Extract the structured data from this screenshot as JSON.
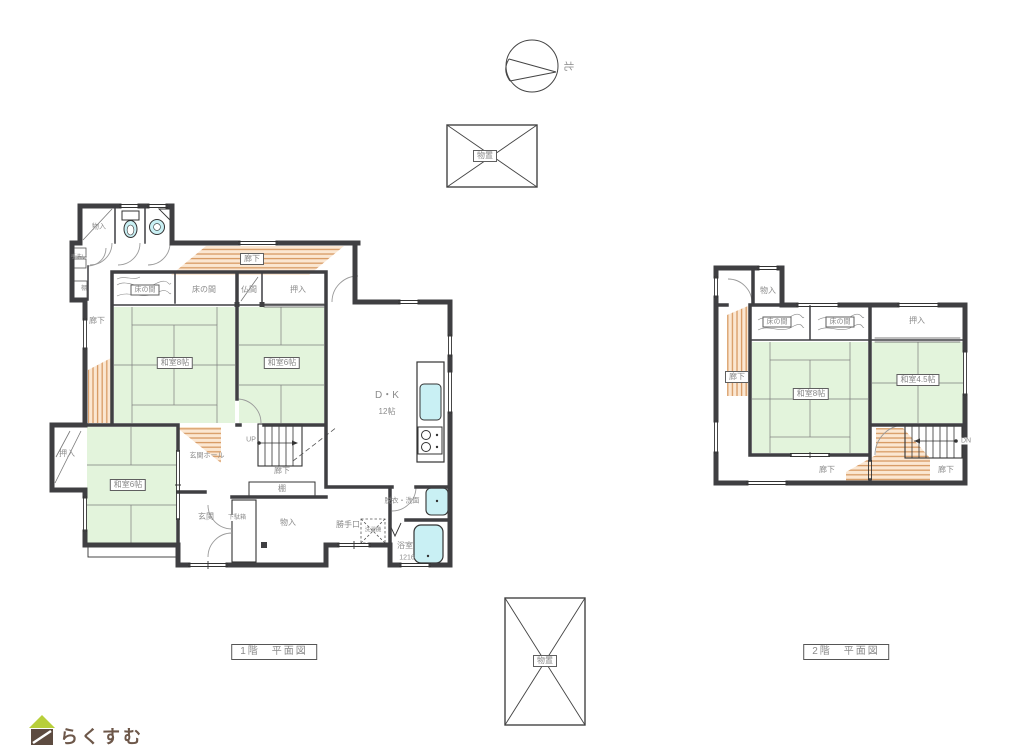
{
  "compass": {
    "north": "北"
  },
  "sheds": {
    "top": "物置",
    "bottom": "物置"
  },
  "floor1": {
    "caption": "1階　平面図",
    "labels": {
      "monoire_top": "物入",
      "tearai": "手洗い",
      "tana_left": "棚",
      "rouka_top": "廊下",
      "tokonoma_a": "床の間",
      "tokonoma_b": "床の間",
      "butsuma": "仏間",
      "oshiire_top": "押入",
      "rouka_left": "廊下",
      "washitsu8": "和室8帖",
      "washitsu6_ne": "和室6帖",
      "dk": "D・K",
      "dk_size": "12帖",
      "oshiire_sw": "押入",
      "washitsu6_sw": "和室6帖",
      "genkan_hall": "玄関ホール",
      "up": "UP",
      "rouka_mid": "廊下",
      "tana_shelf": "棚",
      "genkan": "玄関",
      "getabako": "下駄箱",
      "monoire_low": "物入",
      "katteguchi": "勝手口",
      "sentakuki": "洗濯機",
      "datsui_senmen": "脱衣・洗面",
      "yokushitsu": "浴室",
      "bath_size": "1216"
    }
  },
  "floor2": {
    "caption": "2階　平面図",
    "labels": {
      "monoire": "物入",
      "tokonoma_a": "床の間",
      "tokonoma_b": "床の間",
      "oshiire": "押入",
      "rouka_left": "廊下",
      "washitsu8": "和室8帖",
      "washitsu45": "和室4.5帖",
      "dn": "DN",
      "rouka_b1": "廊下",
      "rouka_b2": "廊下"
    }
  },
  "logo": {
    "text": "らくすむ"
  },
  "colors": {
    "tatami": "#e3f4dc",
    "hatch_line": "#d79a63",
    "hatch_bg": "#fbe7d2",
    "fixture": "#c9f0f4",
    "wall": "#3f3f42",
    "logo_roof": "#b8cf3a",
    "logo_body": "#5d4b40"
  }
}
